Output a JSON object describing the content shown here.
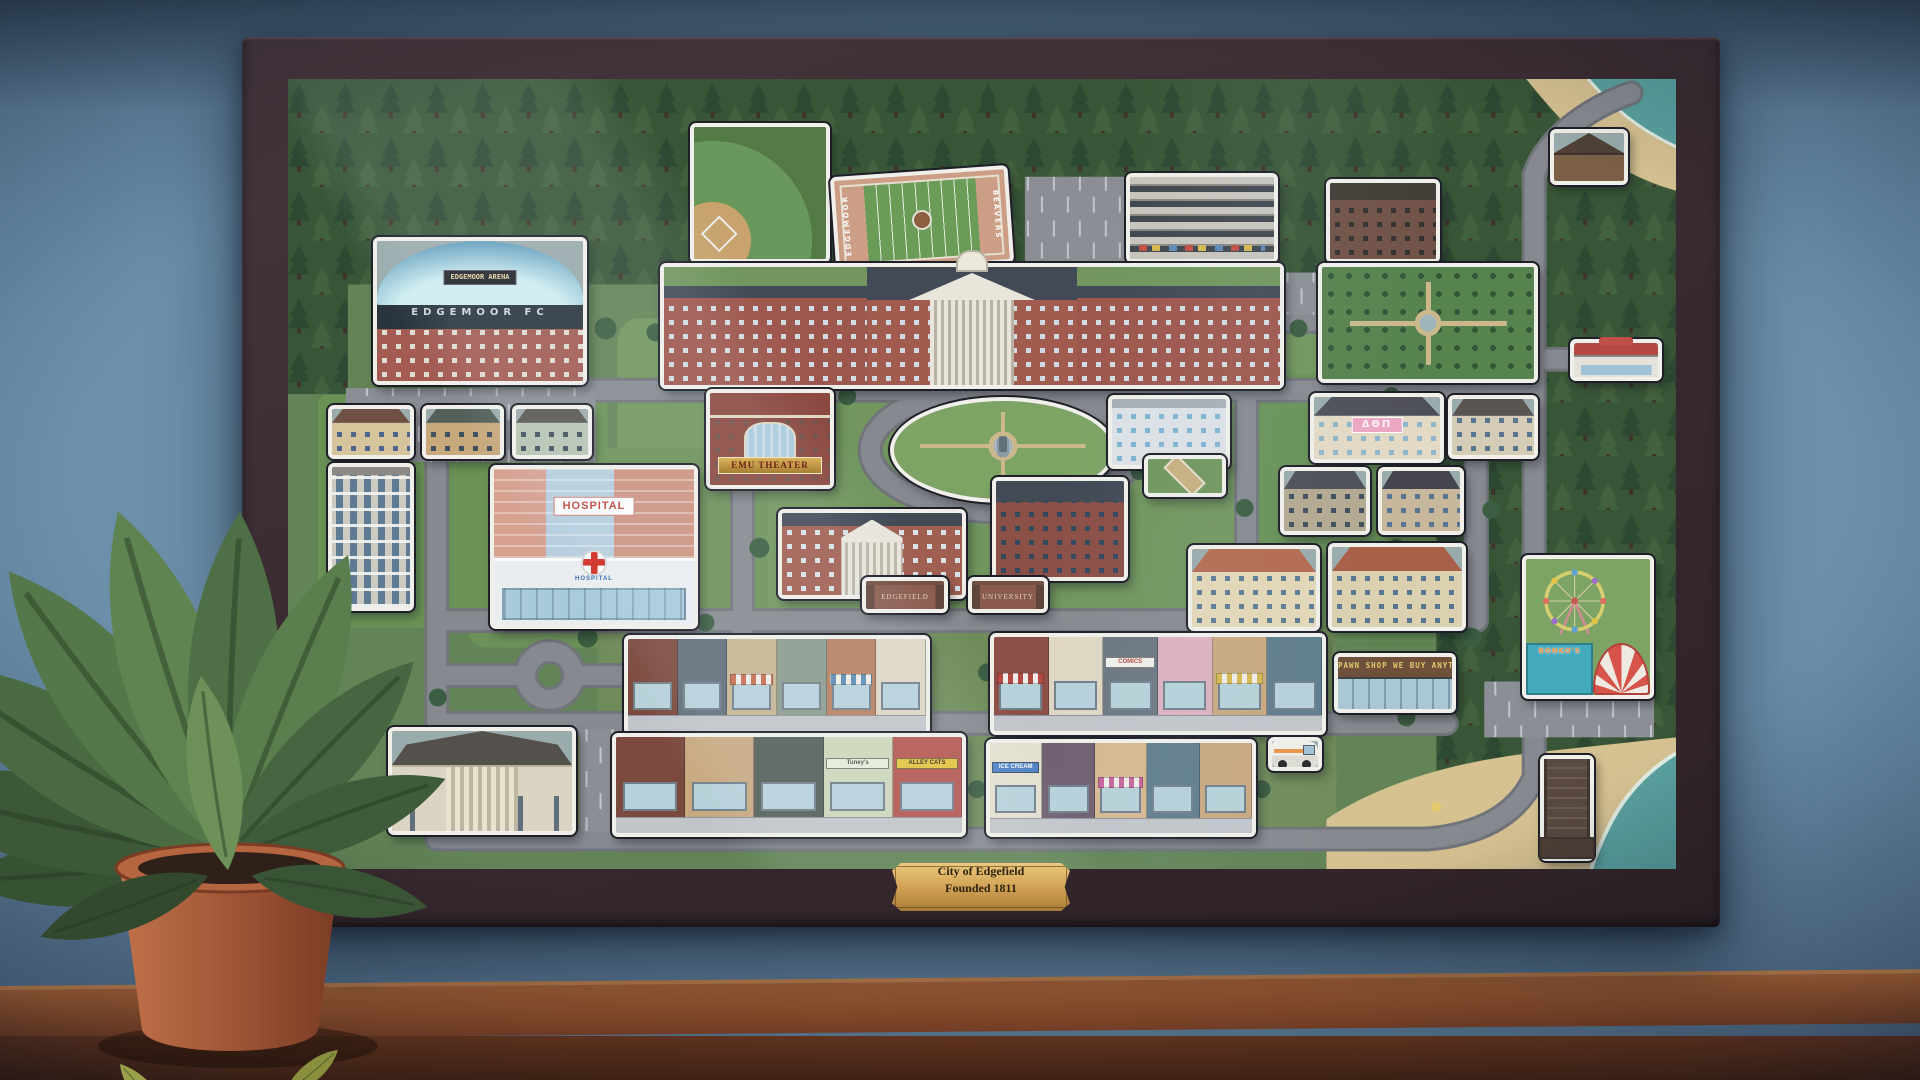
{
  "scene": {
    "plaque": {
      "line1": "City of Edgefield",
      "line2": "Founded 1811"
    },
    "colors": {
      "wall": "#6b8ea9",
      "frame": "#3b2d33",
      "table": "#8a4a28",
      "plaque_gold": "#d9b264",
      "map_green": "#5f8150",
      "road_gray": "#85888d"
    }
  },
  "map": {
    "labels": {
      "stadium_marquee": "EDGEMOOR ARENA",
      "stadium_roof": "EDGEMOOR FC",
      "football_endzone_left": "EDGEMOOR",
      "football_endzone_right": "BEAVERS",
      "theater_marquee": "EMU THEATER",
      "hospital_sign": "HOSPITAL",
      "hospital_entrance": "HOSPITAL",
      "sorority_banner": "ΔΘΠ",
      "gate_left": "EDGEFIELD",
      "gate_right": "UNIVERSITY",
      "comics_sign": "COMICS",
      "pawn_sign": "PAWN SHOP  WE BUY ANYTHING",
      "tuneys_sign": "Tuney's",
      "alley_cats_sign": "ALLEY CATS",
      "ice_cream_sign": "ICE CREAM",
      "bonkos_sign": "BONKO'S"
    },
    "items": [
      {
        "t": "stadium",
        "n": "stadium-edgemoor-arena",
        "x": 85,
        "y": 158,
        "w": 214,
        "h": 148
      },
      {
        "t": "baseball",
        "n": "baseball-field",
        "x": 402,
        "y": 44,
        "w": 140,
        "h": 140
      },
      {
        "t": "football",
        "n": "football-field",
        "x": 545,
        "y": 92,
        "w": 178,
        "h": 98,
        "r": -4
      },
      {
        "t": "garage",
        "n": "parking-garage",
        "x": 838,
        "y": 94,
        "w": 152,
        "h": 90
      },
      {
        "t": "bld",
        "n": "old-apartment-building",
        "x": 1038,
        "y": 100,
        "w": 114,
        "h": 84,
        "o": {
          "b": "#6e4c40",
          "w": "#2c2a26",
          "roof": "#3c362e"
        }
      },
      {
        "t": "cabin",
        "n": "forest-cabin",
        "x": 1262,
        "y": 50,
        "w": 78,
        "h": 56
      },
      {
        "t": "university",
        "n": "university-main-hall",
        "x": 372,
        "y": 184,
        "w": 624,
        "h": 126
      },
      {
        "t": "garden",
        "n": "formal-garden",
        "x": 1030,
        "y": 184,
        "w": 220,
        "h": 120
      },
      {
        "t": "diner",
        "n": "diner",
        "x": 1282,
        "y": 260,
        "w": 92,
        "h": 42
      },
      {
        "t": "theater",
        "n": "emu-theater",
        "x": 418,
        "y": 310,
        "w": 128,
        "h": 100,
        "lab": "theater_marquee"
      },
      {
        "t": "quad",
        "n": "campus-quad-fountain",
        "x": 602,
        "y": 318,
        "w": 226,
        "h": 106
      },
      {
        "t": "glassb",
        "n": "glass-academic-building",
        "x": 820,
        "y": 316,
        "w": 122,
        "h": 74
      },
      {
        "t": "plaza",
        "n": "campus-plaza",
        "x": 856,
        "y": 376,
        "w": 82,
        "h": 42
      },
      {
        "t": "sorority",
        "n": "sorority-house",
        "x": 1022,
        "y": 314,
        "w": 134,
        "h": 70,
        "lab": "sorority_banner"
      },
      {
        "t": "house",
        "n": "house",
        "x": 1160,
        "y": 316,
        "w": 90,
        "h": 64,
        "o": {
          "roof": "#55504a",
          "b": "#d8cdb4",
          "w": "#55728e"
        }
      },
      {
        "t": "house",
        "n": "house",
        "x": 992,
        "y": 388,
        "w": 90,
        "h": 68,
        "o": {
          "roof": "#4a4a52",
          "b": "#b5a88e",
          "w": "#3c4a58"
        }
      },
      {
        "t": "house",
        "n": "house",
        "x": 1090,
        "y": 388,
        "w": 86,
        "h": 68,
        "o": {
          "roof": "#3e3e46",
          "b": "#c9b89a",
          "w": "#55728e"
        }
      },
      {
        "t": "house",
        "n": "house-mediterranean",
        "x": 900,
        "y": 466,
        "w": 132,
        "h": 86,
        "o": {
          "roof": "#b5664a",
          "b": "#e6d8b5",
          "w": "#5a7891"
        }
      },
      {
        "t": "house",
        "n": "house-mediterranean",
        "x": 1040,
        "y": 464,
        "w": 138,
        "h": 88,
        "o": {
          "roof": "#a85a40",
          "b": "#ded2ae",
          "w": "#55728e"
        }
      },
      {
        "t": "house",
        "n": "house",
        "x": 40,
        "y": 326,
        "w": 86,
        "h": 54,
        "o": {
          "roof": "#6e4a3c",
          "b": "#d9c49a",
          "w": "#4a628a"
        }
      },
      {
        "t": "house",
        "n": "house",
        "x": 134,
        "y": 326,
        "w": 82,
        "h": 54,
        "o": {
          "roof": "#4f5a52",
          "b": "#c9a878",
          "w": "#3c4a58"
        }
      },
      {
        "t": "house",
        "n": "house",
        "x": 224,
        "y": 326,
        "w": 80,
        "h": 54,
        "o": {
          "roof": "#55504a",
          "b": "#b8c4b0",
          "w": "#3c4a58"
        }
      },
      {
        "t": "tower",
        "n": "apartment-tower",
        "x": 40,
        "y": 384,
        "w": 86,
        "h": 148
      },
      {
        "t": "hospital",
        "n": "hospital",
        "x": 202,
        "y": 386,
        "w": 208,
        "h": 164
      },
      {
        "t": "hall",
        "n": "campus-hall",
        "x": 490,
        "y": 430,
        "w": 188,
        "h": 90
      },
      {
        "t": "bld",
        "n": "dormitory-building",
        "x": 704,
        "y": 398,
        "w": 136,
        "h": 104,
        "o": {
          "b": "#8a4a3f",
          "w": "#2e4258",
          "roof": "#3d4450"
        }
      },
      {
        "t": "gate",
        "n": "gate-edgefield",
        "x": 574,
        "y": 498,
        "w": 86,
        "h": 36,
        "lab": "gate_left"
      },
      {
        "t": "gate",
        "n": "gate-university",
        "x": 680,
        "y": 498,
        "w": 80,
        "h": 36,
        "lab": "gate_right"
      },
      {
        "t": "shoprow",
        "n": "shops-row-west",
        "x": 336,
        "y": 556,
        "w": 306,
        "h": 100,
        "segs": [
          {
            "c": "#7a4336"
          },
          {
            "c": "#5d6b75"
          },
          {
            "c": "#c9b48e",
            "a": "#c96a4a"
          },
          {
            "c": "#8a9a8a"
          },
          {
            "c": "#b87c5a",
            "a": "#5a8ab5"
          },
          {
            "c": "#e2d8c2"
          }
        ]
      },
      {
        "t": "shoprow",
        "n": "shops-row-east",
        "x": 702,
        "y": 554,
        "w": 336,
        "h": 102,
        "segs": [
          {
            "c": "#8a4a40",
            "a": "#b5423a"
          },
          {
            "c": "#e2d8c2"
          },
          {
            "c": "#68747e",
            "lab": "comics_sign"
          },
          {
            "c": "#e0b0be"
          },
          {
            "c": "#caa87c",
            "a": "#d9b84a"
          },
          {
            "c": "#5d7a8a"
          }
        ]
      },
      {
        "t": "pawnshop",
        "n": "pawn-shop",
        "x": 1046,
        "y": 574,
        "w": 122,
        "h": 60,
        "lab": "pawn_sign"
      },
      {
        "t": "ferrispark",
        "n": "amusement-park-bonkos",
        "x": 1234,
        "y": 476,
        "w": 132,
        "h": 144,
        "lab": "bonkos_sign"
      },
      {
        "t": "shoprow",
        "n": "shops-row-south-west",
        "x": 324,
        "y": 654,
        "w": 354,
        "h": 104,
        "segs": [
          {
            "c": "#7a4336"
          },
          {
            "c": "#caa87c"
          },
          {
            "c": "#4f5a52"
          },
          {
            "c": "#cfd9b8",
            "lab": "tuneys_sign",
            "sb": "#e9efdc",
            "st": "#4a4a3a"
          },
          {
            "c": "#b5524a",
            "lab": "alley_cats_sign",
            "sb": "#e8c43a",
            "st": "#2e2415"
          }
        ]
      },
      {
        "t": "shoprow",
        "n": "shops-row-south-east",
        "x": 698,
        "y": 660,
        "w": 270,
        "h": 98,
        "segs": [
          {
            "c": "#e8e2cf",
            "lab": "ice_cream_sign",
            "sb": "#4a7ec2",
            "st": "#ffffff"
          },
          {
            "c": "#6e5a6e"
          },
          {
            "c": "#d9b88e",
            "a": "#c9609a"
          },
          {
            "c": "#5d7a8a"
          },
          {
            "c": "#caa87c"
          }
        ]
      },
      {
        "t": "truck",
        "n": "ice-cream-truck",
        "x": 980,
        "y": 658,
        "w": 54,
        "h": 34
      },
      {
        "t": "church",
        "n": "church",
        "x": 100,
        "y": 648,
        "w": 188,
        "h": 108
      },
      {
        "t": "pier",
        "n": "pier",
        "x": 1252,
        "y": 676,
        "w": 54,
        "h": 106
      }
    ]
  }
}
